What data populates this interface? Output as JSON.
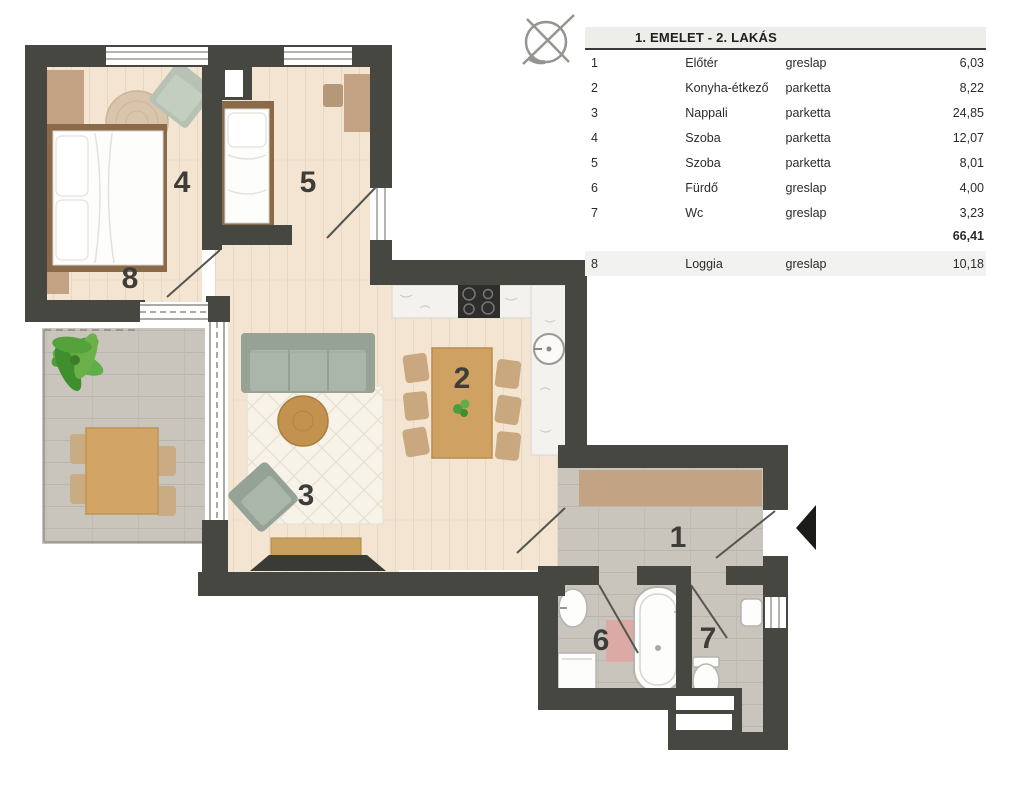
{
  "legend": {
    "title": "1. EMELET - 2. LAKÁS",
    "rows": [
      {
        "no": "1",
        "name": "Előtér",
        "material": "greslap",
        "area": "6,03"
      },
      {
        "no": "2",
        "name": "Konyha-étkező",
        "material": "parketta",
        "area": "8,22"
      },
      {
        "no": "3",
        "name": "Nappali",
        "material": "parketta",
        "area": "24,85"
      },
      {
        "no": "4",
        "name": "Szoba",
        "material": "parketta",
        "area": "12,07"
      },
      {
        "no": "5",
        "name": "Szoba",
        "material": "parketta",
        "area": "8,01"
      },
      {
        "no": "6",
        "name": "Fürdő",
        "material": "greslap",
        "area": "4,00"
      },
      {
        "no": "7",
        "name": "Wc",
        "material": "greslap",
        "area": "3,23"
      }
    ],
    "total": "66,41",
    "extra_row": {
      "no": "8",
      "name": "Loggia",
      "material": "greslap",
      "area": "10,18"
    }
  },
  "plan": {
    "labels": {
      "hall": "1",
      "kitchen": "2",
      "living": "3",
      "bedroom1": "4",
      "bedroom2": "5",
      "bath": "6",
      "wc": "7",
      "loggia": "8"
    }
  },
  "icons": {
    "north_indicator": "compass-icon",
    "entrance_marker": "entrance-arrow"
  },
  "colors": {
    "wall": "#474741",
    "wood_floor": "#f3e5d1",
    "tile_floor": "#c9c5bd",
    "marble_counter": "#f4f2ee",
    "furniture_tan": "#c2a282",
    "furniture_wood": "#c89a5f",
    "sofa_sage": "#a7b2a7",
    "rug_cream": "#f7f3e9",
    "mat_pink": "#dcaaa4",
    "plant_green": "#55a23d",
    "label_text": "#3d3d39"
  }
}
